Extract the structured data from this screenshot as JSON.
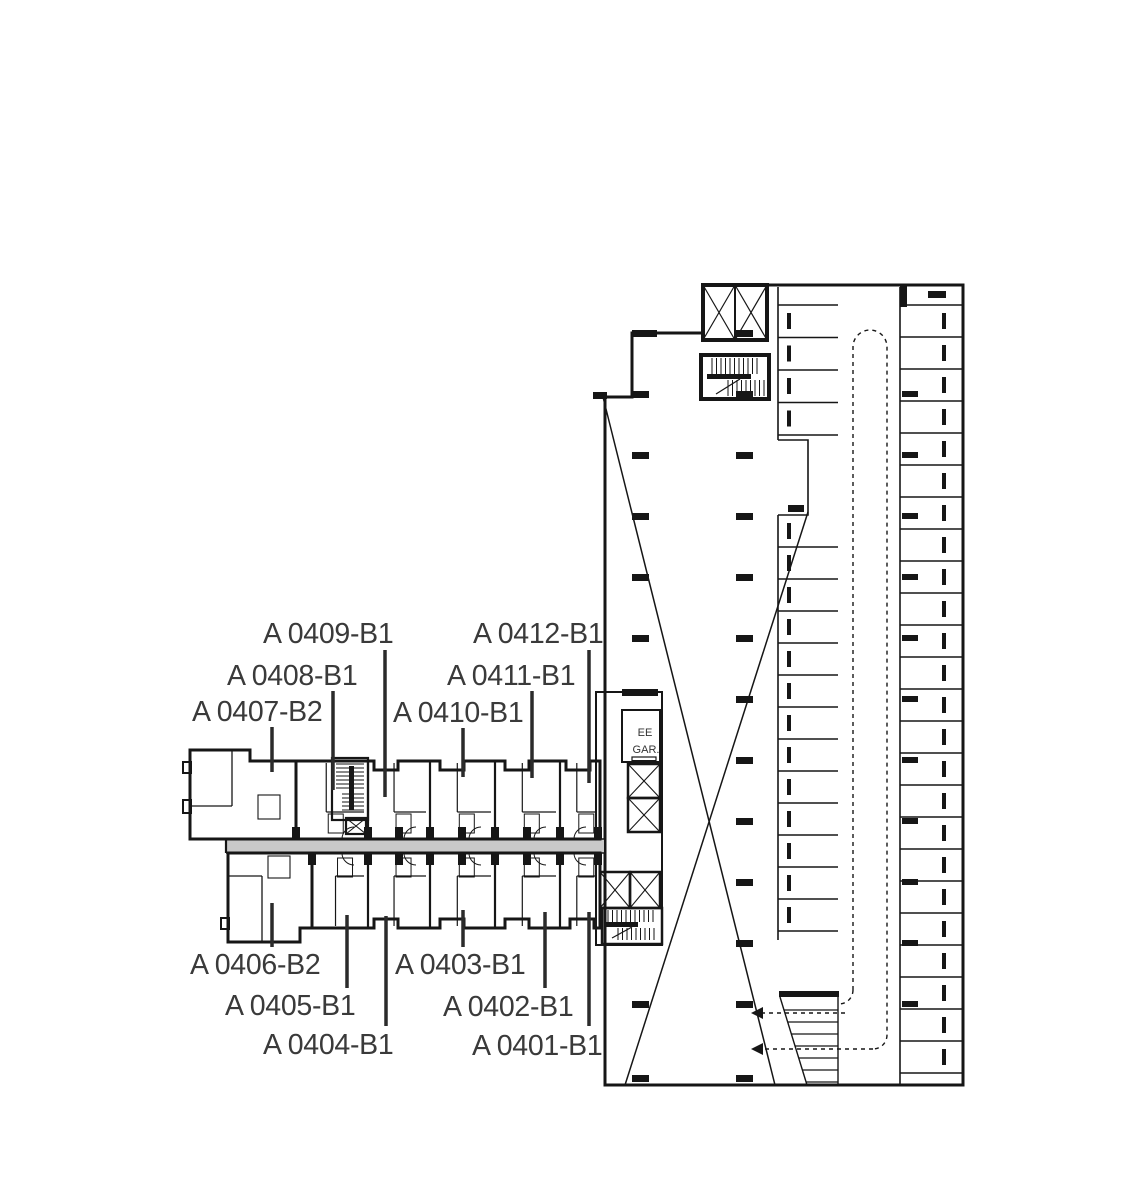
{
  "plan": {
    "kind": "floor-plan",
    "colors": {
      "b1_green": "#b5d787",
      "b2_pink": "#ef5f9e",
      "garage_gray": "#d4d4d4",
      "corridor_gray": "#c9c9c9",
      "wall_black": "#161616",
      "label_gray": "#3a3a3a",
      "leader_gray": "#2b2b2b"
    },
    "unit_types": {
      "B1": "green",
      "B2": "pink"
    },
    "garage": {
      "elevator_label": "EE",
      "garage_label": "GAR."
    },
    "units": [
      {
        "id": "A 0401-B1",
        "plan": "B1",
        "tx": 472,
        "ty": 1055,
        "lx": 589,
        "ly1": 1026,
        "ly2": 912
      },
      {
        "id": "A 0402-B1",
        "plan": "B1",
        "tx": 443,
        "ty": 1016,
        "lx": 545,
        "ly1": 988,
        "ly2": 912
      },
      {
        "id": "A 0403-B1",
        "plan": "B1",
        "tx": 395,
        "ty": 974,
        "lx": 463,
        "ly1": 947,
        "ly2": 910
      },
      {
        "id": "A 0404-B1",
        "plan": "B1",
        "tx": 263,
        "ty": 1054,
        "lx": 386,
        "ly1": 1026,
        "ly2": 916
      },
      {
        "id": "A 0405-B1",
        "plan": "B1",
        "tx": 225,
        "ty": 1015,
        "lx": 347,
        "ly1": 988,
        "ly2": 915
      },
      {
        "id": "A 0406-B2",
        "plan": "B2",
        "tx": 190,
        "ty": 974,
        "lx": 272,
        "ly1": 947,
        "ly2": 903
      },
      {
        "id": "A 0407-B2",
        "plan": "B2",
        "tx": 192,
        "ty": 721,
        "lx": 272,
        "ly1": 727,
        "ly2": 772
      },
      {
        "id": "A 0408-B1",
        "plan": "B1",
        "tx": 227,
        "ty": 685,
        "lx": 333,
        "ly1": 691,
        "ly2": 790
      },
      {
        "id": "A 0409-B1",
        "plan": "B1",
        "tx": 263,
        "ty": 643,
        "lx": 385,
        "ly1": 650,
        "ly2": 797
      },
      {
        "id": "A 0410-B1",
        "plan": "B1",
        "tx": 393,
        "ty": 722,
        "lx": 463,
        "ly1": 728,
        "ly2": 777
      },
      {
        "id": "A 0411-B1",
        "plan": "B1",
        "tx": 447,
        "ty": 685,
        "lx": 532,
        "ly1": 691,
        "ly2": 778
      },
      {
        "id": "A 0412-B1",
        "plan": "B1",
        "tx": 473,
        "ty": 643,
        "lx": 589,
        "ly1": 650,
        "ly2": 783
      }
    ]
  }
}
